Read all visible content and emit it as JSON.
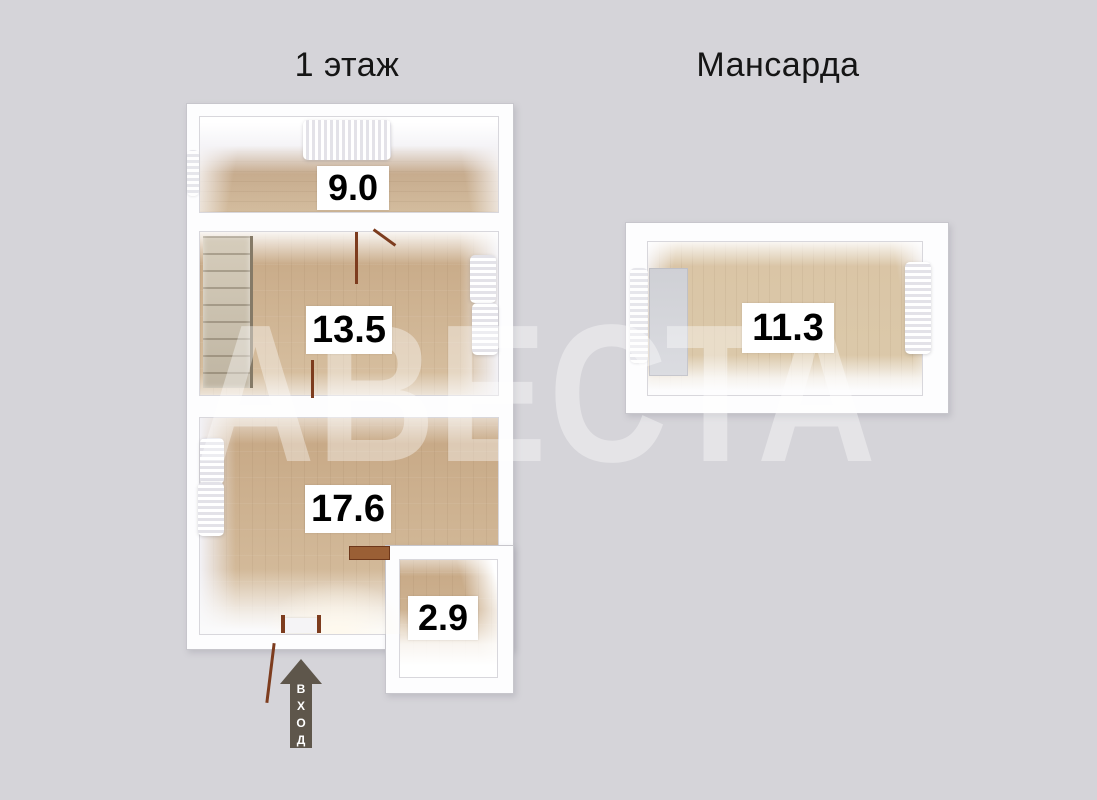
{
  "titles": {
    "floor1": "1 этаж",
    "attic": "Мансарда"
  },
  "watermark": {
    "text": "АВЕСТА"
  },
  "plan1": {
    "name": "Первый этаж",
    "rooms": [
      {
        "name": "room-top",
        "area": "9.0"
      },
      {
        "name": "room-middle",
        "area": "13.5"
      },
      {
        "name": "room-bottom",
        "area": "17.6"
      },
      {
        "name": "room-annex",
        "area": "2.9"
      }
    ],
    "features": [
      "staircase",
      "doors",
      "windows-with-curtains",
      "entrance-door"
    ]
  },
  "plan2": {
    "name": "Мансарда",
    "rooms": [
      {
        "name": "room-attic",
        "area": "11.3"
      }
    ],
    "features": [
      "stair-opening",
      "windows-with-curtains"
    ]
  },
  "entrance": {
    "label": "ВХОД"
  },
  "colors": {
    "background": "#d5d4d9",
    "wall": "#fdfdfe",
    "wall_border": "#c7c6cc",
    "wood_floor": "#cfb291",
    "wood_floor_dark": "#b59476",
    "door_brown": "#7d3c1e",
    "arrow": "#5e564b",
    "label_bg": "#ffffff",
    "label_text": "#000000",
    "watermark": "rgba(255,255,255,0.38)"
  }
}
